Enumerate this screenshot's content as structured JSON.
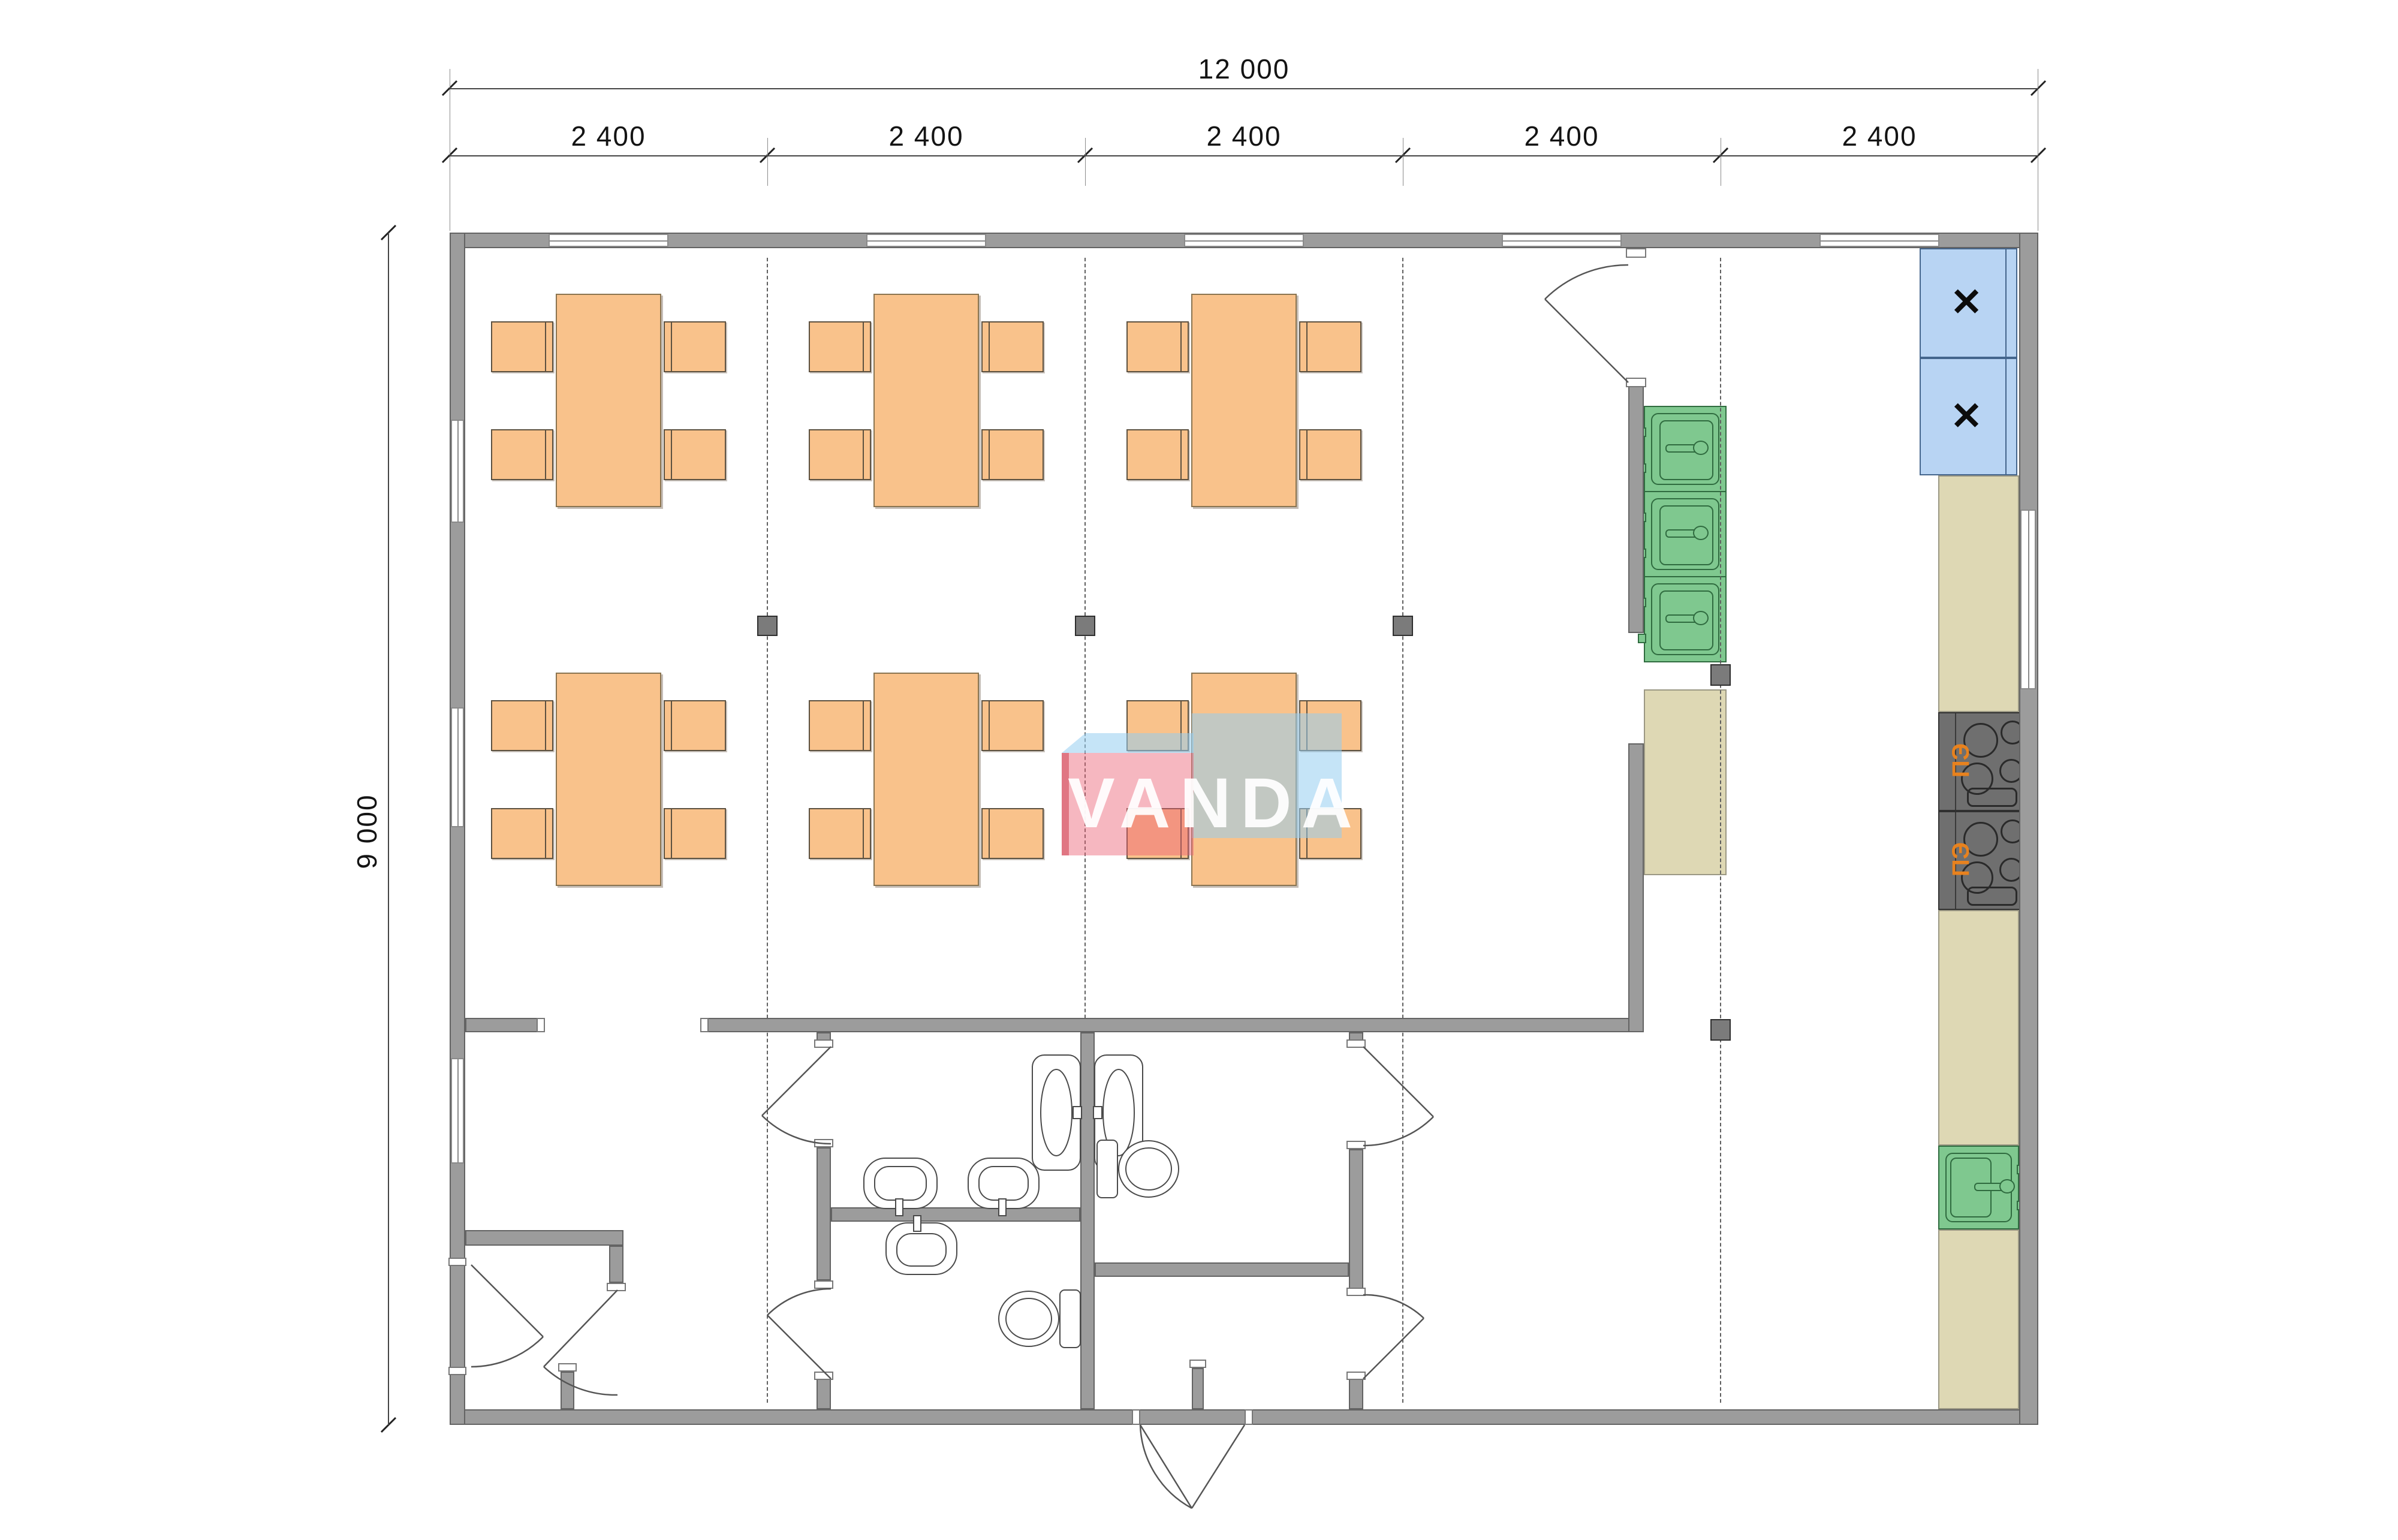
{
  "meta": {
    "drawing_type": "floor-plan",
    "watermark_text": "VANDA"
  },
  "dimensions": {
    "total_width": {
      "label": "12 000"
    },
    "total_height": {
      "label": "9 000"
    },
    "modules": [
      {
        "label": "2 400"
      },
      {
        "label": "2 400"
      },
      {
        "label": "2 400"
      },
      {
        "label": "2 400"
      },
      {
        "label": "2 400"
      }
    ]
  },
  "kitchen": {
    "stoves": [
      {
        "label": "ПЭ"
      },
      {
        "label": "ПЭ"
      }
    ],
    "wall_cabinets": [
      {
        "label": "✕"
      },
      {
        "label": "✕"
      }
    ]
  },
  "palette": {
    "wall_gray": "#9C9C9C",
    "column_gray": "#7B7B7B",
    "furniture_orange": "#F9C28B",
    "sink_green": "#7FC88F",
    "cabinet_blue": "#B8D4F3",
    "counter_tan": "#DED8B4",
    "stove_gray": "#6F6F6F",
    "stove_label_orange": "#E8821E",
    "watermark_pink": "#EA6074",
    "watermark_blue": "#96CBF0"
  }
}
